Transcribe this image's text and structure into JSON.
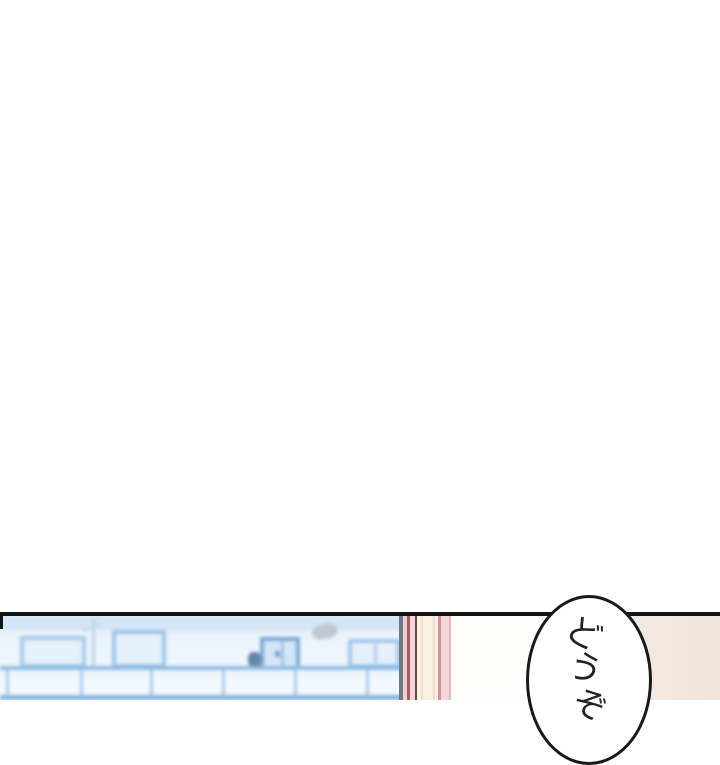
{
  "scene": {
    "kind": "webtoon-comic-panel",
    "blank_top_area": "white",
    "panel_divider_color": "#141414"
  },
  "panel": {
    "left_view": "blurred-blue-apartment-building",
    "middle": "pink-window-frame",
    "right": "room-wall"
  },
  "speech_bubble": {
    "text": "どうぞ",
    "chars": [
      "ど",
      "う",
      "ぞ"
    ],
    "fill": "#ffffff",
    "border_color": "#191919",
    "text_color": "#222222"
  },
  "colors": {
    "building_blue_light": "#eef5fc",
    "building_blue_line": "#8fbbe4",
    "building_frame_blue": "#a6cbec",
    "frame_pink": "#f4d4d6",
    "frame_red_line": "#a25b61",
    "frame_maroon_line": "#6f4347",
    "frame_cream": "#faf2e1",
    "wall_white": "#fefefd",
    "wall_cream": "#f3eae1",
    "divider_black": "#141414"
  }
}
